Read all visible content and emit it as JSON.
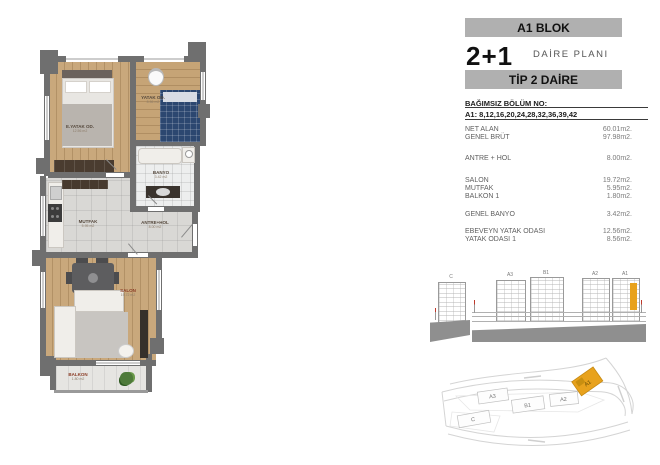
{
  "header": {
    "block": "A1 BLOK",
    "unit": "2+1",
    "plan": "DAİRE PLANI",
    "tip": "TİP 2 DAİRE"
  },
  "unit_info": {
    "title": "BAĞIMSIZ BÖLÜM NO:",
    "numbers": "A1: 8,12,16,20,24,28,32,36,39,42",
    "summary": [
      {
        "label": "NET ALAN",
        "value": "60.01m2."
      },
      {
        "label": "GENEL BRÜT",
        "value": "97.98m2."
      }
    ],
    "groups": [
      [
        {
          "label": "ANTRE + HOL",
          "value": "8.00m2."
        }
      ],
      [
        {
          "label": "SALON",
          "value": "19.72m2."
        },
        {
          "label": "MUTFAK",
          "value": "5.95m2."
        },
        {
          "label": "BALKON 1",
          "value": "1.80m2."
        }
      ],
      [
        {
          "label": "GENEL BANYO",
          "value": "3.42m2."
        }
      ],
      [
        {
          "label": "EBEVEYN YATAK ODASI",
          "value": "12.56m2."
        },
        {
          "label": "YATAK ODASI 1",
          "value": "8.56m2."
        }
      ]
    ]
  },
  "floor_plan": {
    "rooms": [
      {
        "label": "E.YATAK OD.",
        "area": "12.56 m2"
      },
      {
        "label": "YATAK OD.",
        "area": "8.56 m2"
      },
      {
        "label": "BANYO",
        "area": "3.42 m2"
      },
      {
        "label": "MUTFAK",
        "area": "5.95 m2"
      },
      {
        "label": "ANTRE+HOL",
        "area": "8.00 m2"
      },
      {
        "label": "SALON",
        "area": "19.72 m2"
      },
      {
        "label": "BALKON",
        "area": "1.80 m2"
      }
    ]
  },
  "elevation": {
    "labels": [
      "C",
      "A3",
      "B1",
      "A2",
      "A1"
    ],
    "highlight": "A1",
    "highlight_color": "#E8A21D"
  },
  "site_plan": {
    "labels": [
      "A3",
      "B1",
      "A2",
      "C",
      "A1"
    ],
    "highlight": "A1",
    "highlight_color": "#E8A21D"
  }
}
